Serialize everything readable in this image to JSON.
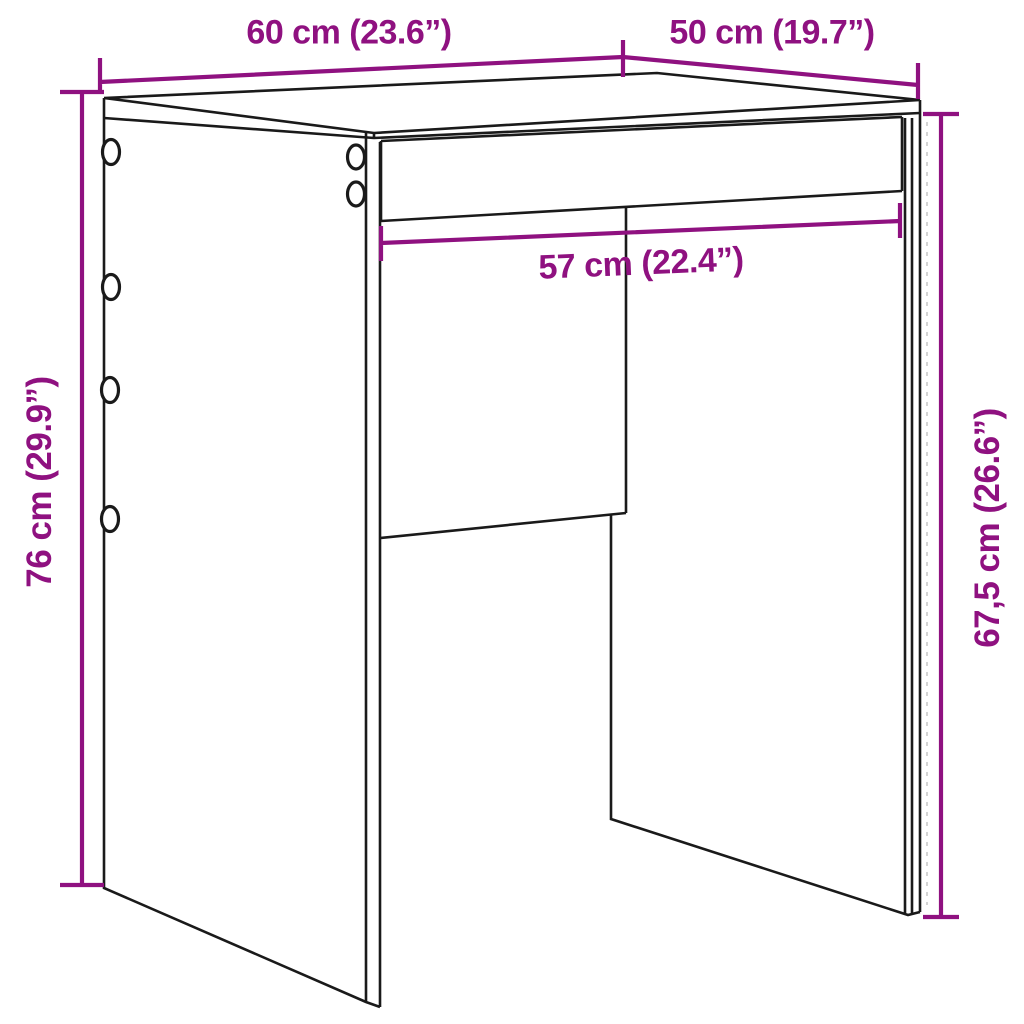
{
  "page": {
    "background": "#ffffff",
    "description": "Furniture dimension line drawing of a desk/stool with drawer rail"
  },
  "diagram": {
    "colors": {
      "dimension_accent": "#8F1180",
      "outline": "#1A1A1A",
      "hidden_edge": "#C9C9C9"
    },
    "labels": {
      "top_width": "60 cm (23.6”)",
      "top_depth": "50 cm (19.7”)",
      "inner_width": "57 cm (22.4”)",
      "left_height": "76 cm (29.9”)",
      "right_clearance": "67,5 cm (26.6”)"
    }
  }
}
